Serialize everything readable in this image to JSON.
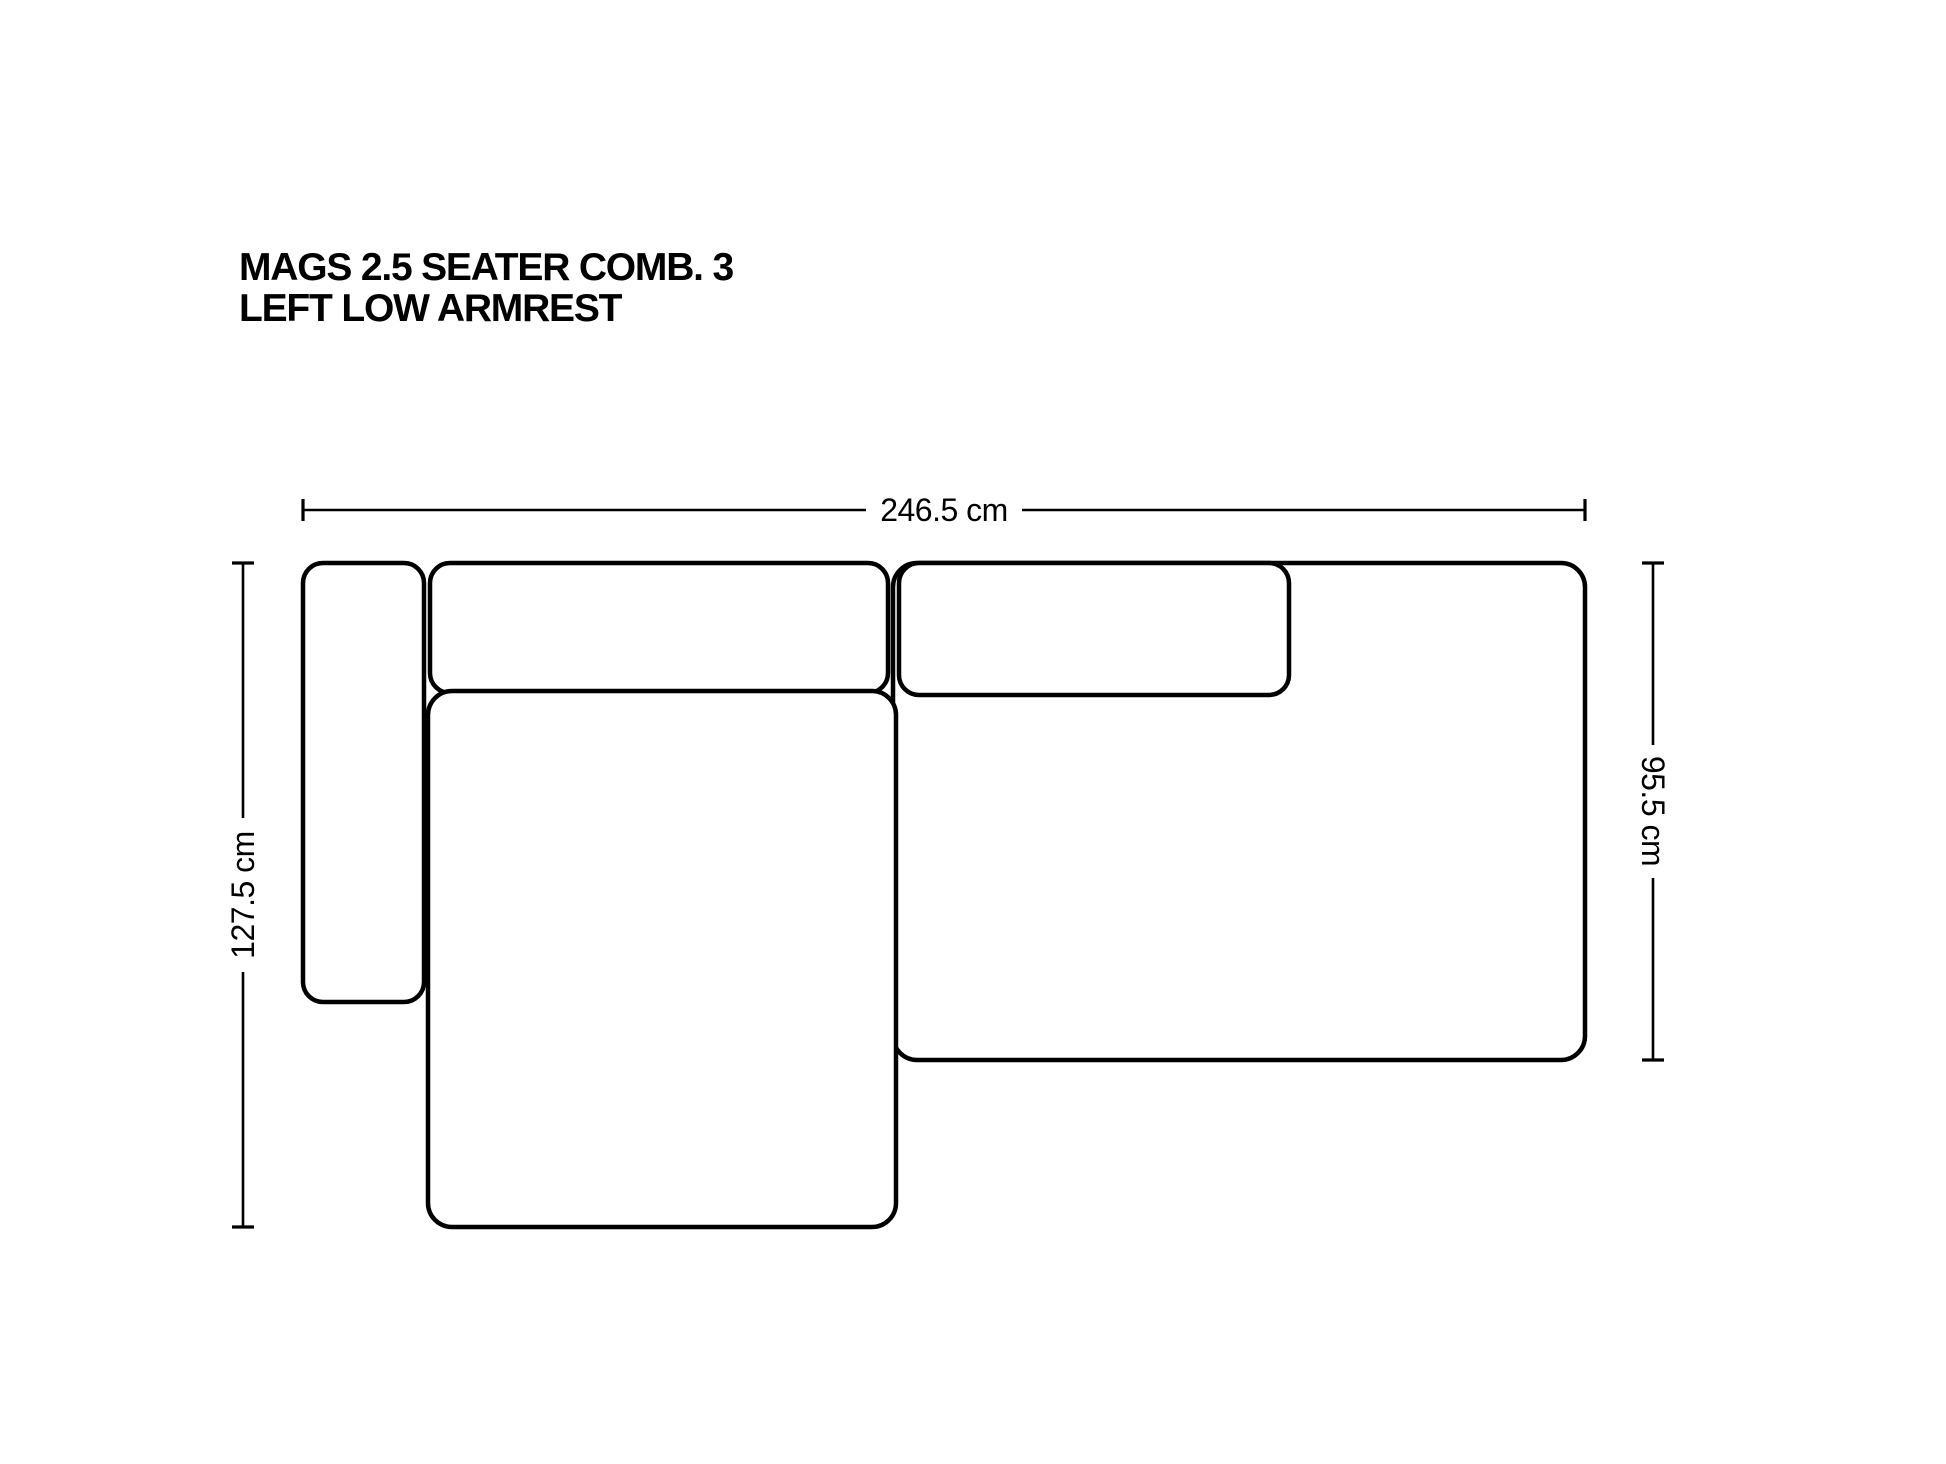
{
  "title": {
    "line1": "MAGS 2.5 SEATER COMB. 3",
    "line2": "LEFT LOW ARMREST"
  },
  "dimensions": {
    "overall_width": "246.5 cm",
    "left_depth": "127.5 cm",
    "right_depth": "95.5 cm"
  },
  "modules": {
    "armrest": "left-low-armrest",
    "left_back": "left-back-cushion",
    "right_back": "right-back-cushion",
    "chaise": "left-seat-chaise-module",
    "right_seat": "right-seat-module"
  },
  "colors": {
    "line": "#000000",
    "text": "#000000",
    "background": "#ffffff"
  }
}
